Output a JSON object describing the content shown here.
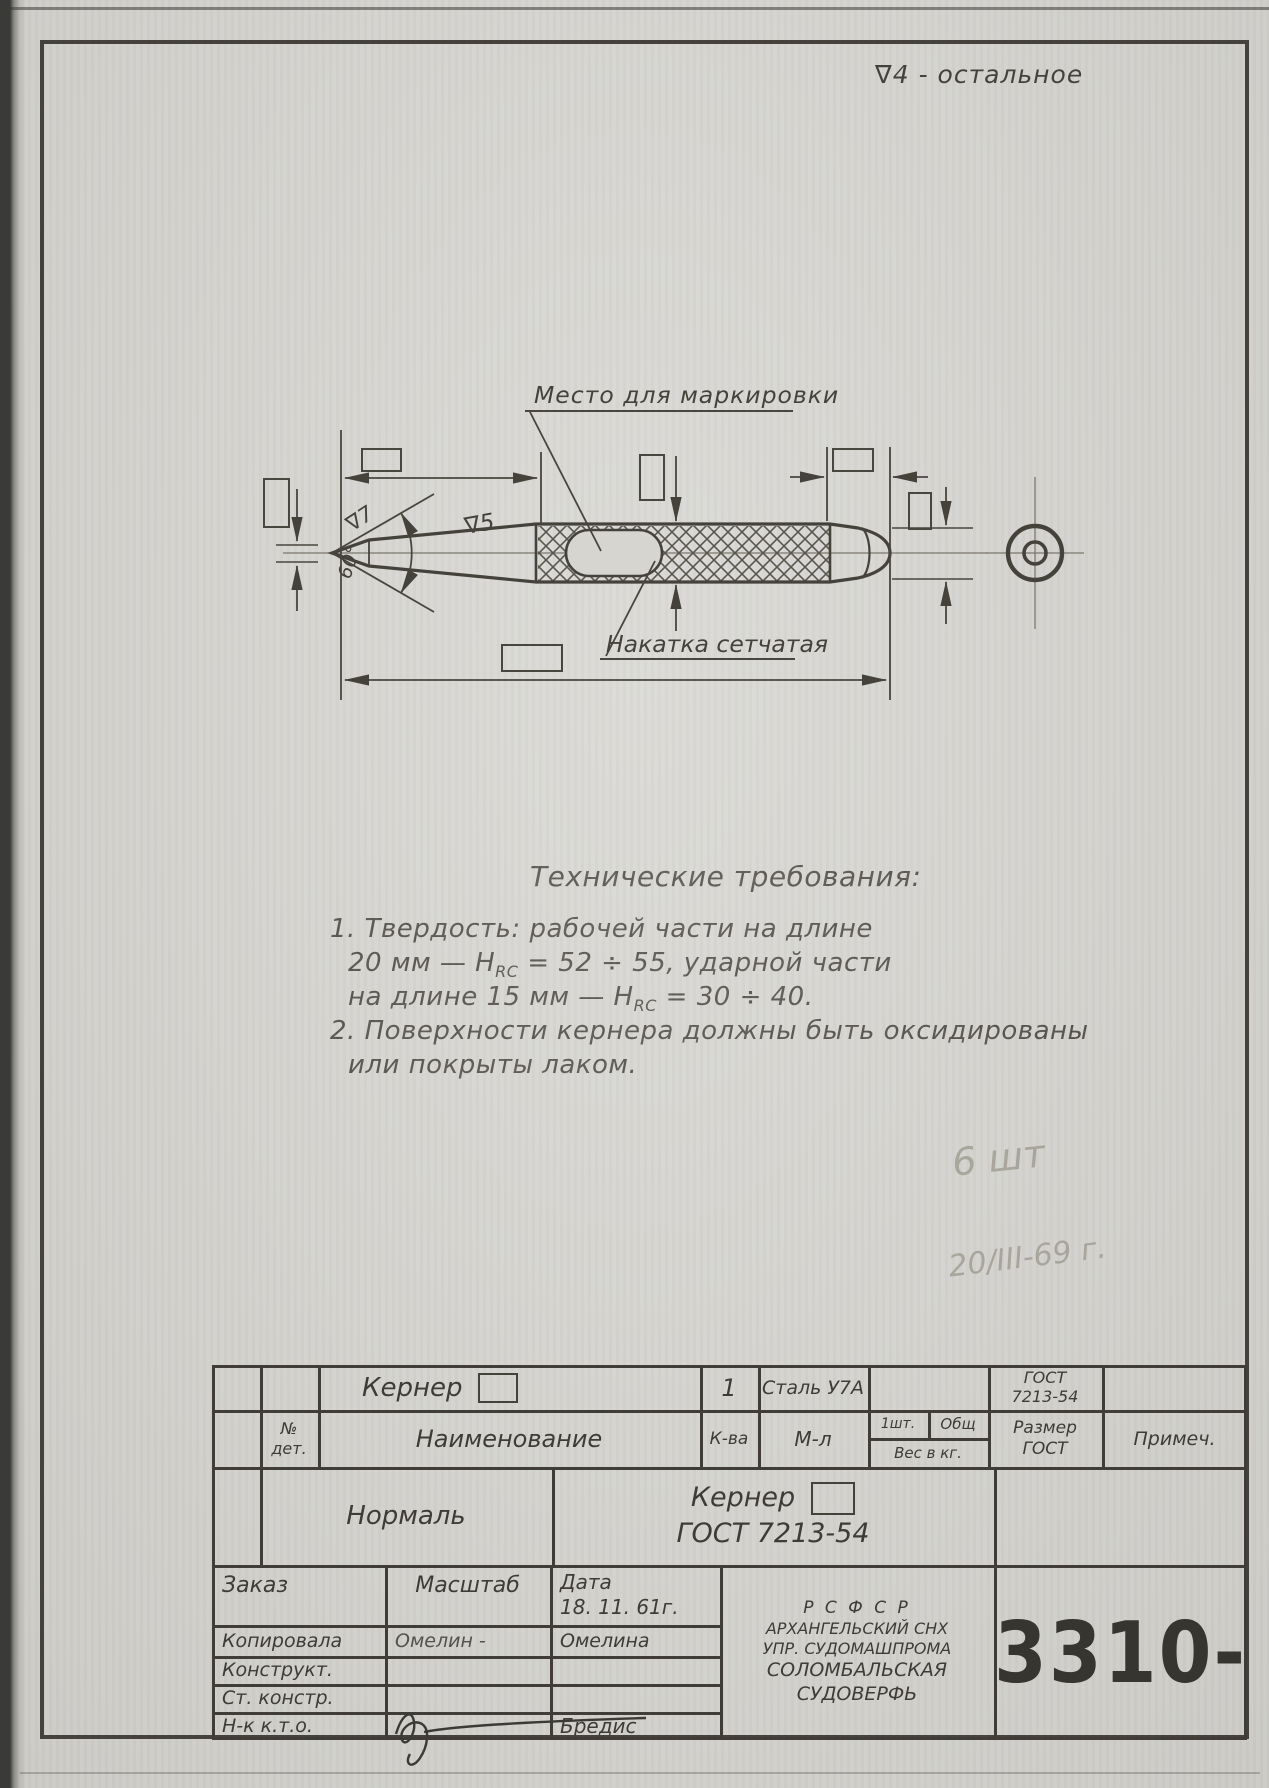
{
  "page": {
    "finish_note": "∇4 - остальное"
  },
  "colors": {
    "paper": "#d6d5d0",
    "ink": "#45423c",
    "pencil": "#a29e94"
  },
  "drawing": {
    "marking_label": "Место для маркировки",
    "knurl_label": "Накатка сетчатая",
    "angle_label": "60°",
    "finish_tip": "∇7",
    "finish_taper": "∇5"
  },
  "tech": {
    "heading": "Технические требования:",
    "item1_line1": "1. Твердость:  рабочей части на длине",
    "item1_line2_pre": "20 мм — H",
    "item1_line2_sub": "RC",
    "item1_line2_post": " = 52 ÷ 55,  ударной части",
    "item1_line3_pre": "на длине 15 мм — H",
    "item1_line3_sub": "RC",
    "item1_line3_post": " = 30 ÷ 40.",
    "item2_line1": "2. Поверхности кернера должны быть оксидированы",
    "item2_line2": "или покрыты лаком."
  },
  "pencil_notes": {
    "quantity": "6 шт",
    "date": "20/III-69 г."
  },
  "title_block": {
    "row1": {
      "name": "Кернер",
      "qty": "1",
      "material": "Сталь У7А",
      "gost_line1": "ГОСТ",
      "gost_line2": "7213-54"
    },
    "headers": {
      "det_line1": "№",
      "det_line2": "дет.",
      "name": "Наименование",
      "qty": "К-ва",
      "material": "М-л",
      "per_item": "1шт.",
      "total": "Общ",
      "weight": "Вес в кг.",
      "size_line1": "Размер",
      "size_line2": "ГОСТ",
      "note": "Примеч."
    },
    "middle": {
      "type": "Нормаль",
      "title_line1": "Кернер",
      "title_line2": "ГОСТ  7213-54"
    },
    "bottom": {
      "order": "Заказ",
      "scale": "Масштаб",
      "date_label": "Дата",
      "date_value": "18. 11. 61г.",
      "rows": [
        {
          "label": "Копировала",
          "scale_col": "Омелин -",
          "date_col": "Омелина"
        },
        {
          "label": "Конструкт.",
          "scale_col": "",
          "date_col": ""
        },
        {
          "label": "Ст. констр.",
          "scale_col": "",
          "date_col": ""
        },
        {
          "label": "Н-к  к.т.о.",
          "scale_col": "",
          "date_col": "Бредис"
        }
      ],
      "org_line1": "Р С Ф С Р",
      "org_line2": "АРХАНГЕЛЬСКИЙ СНХ",
      "org_line3": "УПР. СУДОМАШПРОМА",
      "org_line4": "СОЛОМБАЛЬСКАЯ",
      "org_line5": "СУДОВЕРФЬ",
      "number": "3310-"
    }
  }
}
